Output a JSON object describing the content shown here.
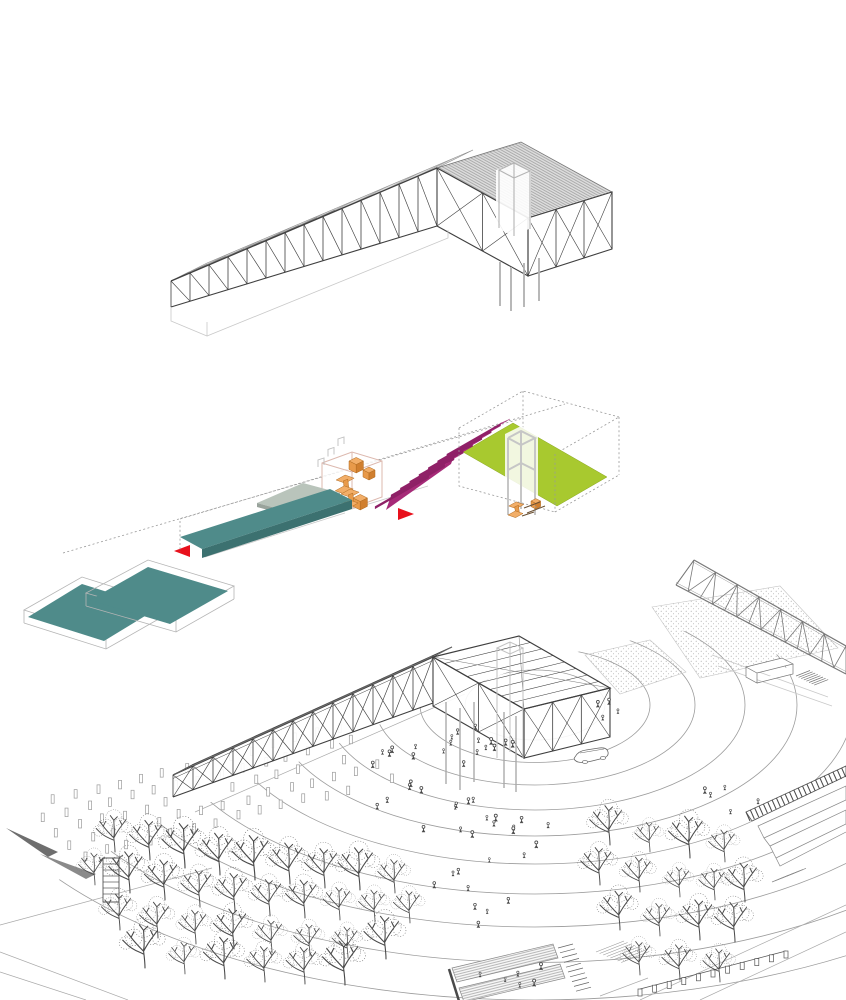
{
  "canvas": {
    "width": 846,
    "height": 1000,
    "background": "#ffffff"
  },
  "figure": {
    "type": "architectural-axonometric-diagram-set",
    "panels": [
      {
        "id": "structure",
        "role": "roof-structure-axonometric"
      },
      {
        "id": "program",
        "role": "exploded-program-axonometric"
      },
      {
        "id": "site",
        "role": "site-context-axonometric"
      }
    ]
  },
  "palette": {
    "paper": "#ffffff",
    "ink": "#3f3f3f",
    "mid": "#777777",
    "light": "#aaaaaa",
    "faint": "#c9c9c9",
    "roof_fill": "#dcdcdc",
    "roof_line": "#9a9a9a",
    "teal": "#4f8b8a",
    "teal_dark": "#3c7170",
    "sage": "#b9c4bb",
    "sage_edge": "#99a39b",
    "magenta": "#c2308a",
    "magenta_mid": "#a62a78",
    "magenta_dark": "#8e2066",
    "lime": "#a8c92f",
    "lime_edge": "#8aa620",
    "orange": "#f2ae68",
    "orange_mid": "#e89a4a",
    "orange_dark": "#d07f2f",
    "orange_line": "#b06a20",
    "red": "#e8101c",
    "tower_gray": "#c6c6c6",
    "box_pink": "#dcb8ae",
    "tree_ink": "#4a4a4a",
    "crowd_ink": "#444444"
  }
}
